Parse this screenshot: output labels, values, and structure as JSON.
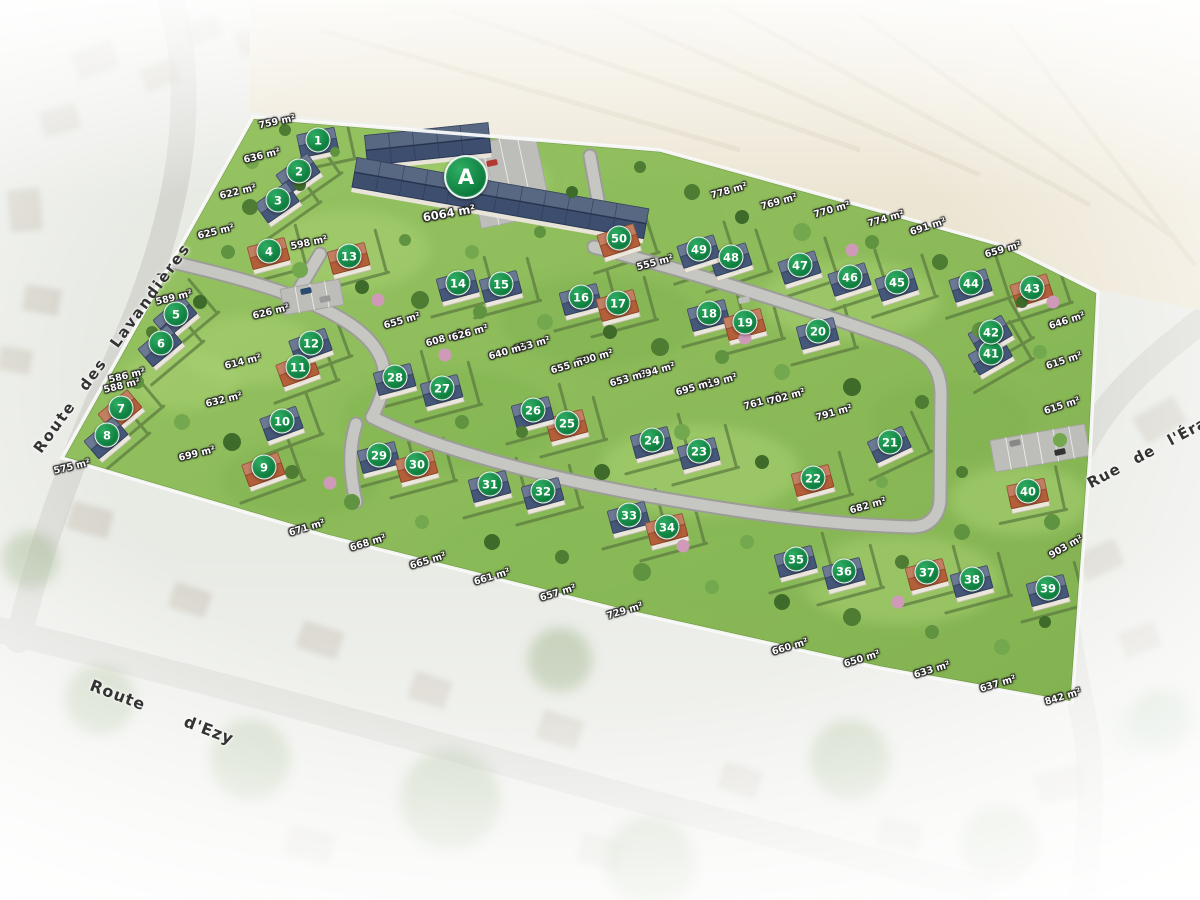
{
  "plan": {
    "type": "residential-subdivision-aerial-plan",
    "marker_color": "#0b7a3c",
    "roof_slate_color": "#46587a",
    "roof_tile_color": "#b35f3a",
    "lawn_color": "#8fbe5c",
    "road_color": "#c6c6c2",
    "field_color": "#ece5d3"
  },
  "streets": [
    {
      "name": "Route des Lavandières",
      "x": 112,
      "y": 348,
      "rot": -54
    },
    {
      "name": "Route d'Ezy",
      "x": 162,
      "y": 712,
      "rot": 21
    },
    {
      "name": "Rue de l'Érable",
      "x": 1160,
      "y": 446,
      "rot": -28
    }
  ],
  "special_lot": {
    "label": "A",
    "x": 466,
    "y": 177,
    "area": "6064 m²",
    "area_x": 449,
    "area_y": 213,
    "area_rot": -10
  },
  "lots": [
    {
      "n": 1,
      "x": 318,
      "y": 140,
      "roof": "slate",
      "rot": -12
    },
    {
      "n": 2,
      "x": 299,
      "y": 171,
      "roof": "slate",
      "rot": -35
    },
    {
      "n": 3,
      "x": 278,
      "y": 200,
      "roof": "slate",
      "rot": -35
    },
    {
      "n": 4,
      "x": 269,
      "y": 251,
      "roof": "tile",
      "rot": -15
    },
    {
      "n": 5,
      "x": 176,
      "y": 314,
      "roof": "slate",
      "rot": -40
    },
    {
      "n": 6,
      "x": 161,
      "y": 343,
      "roof": "slate",
      "rot": -40
    },
    {
      "n": 7,
      "x": 121,
      "y": 408,
      "roof": "tile",
      "rot": -40
    },
    {
      "n": 8,
      "x": 107,
      "y": 435,
      "roof": "slate",
      "rot": -40
    },
    {
      "n": 9,
      "x": 264,
      "y": 467,
      "roof": "tile",
      "rot": -20
    },
    {
      "n": 10,
      "x": 282,
      "y": 421,
      "roof": "slate",
      "rot": -20
    },
    {
      "n": 11,
      "x": 298,
      "y": 367,
      "roof": "tile",
      "rot": -20
    },
    {
      "n": 12,
      "x": 311,
      "y": 343,
      "roof": "slate",
      "rot": -20
    },
    {
      "n": 13,
      "x": 349,
      "y": 256,
      "roof": "tile",
      "rot": -15
    },
    {
      "n": 14,
      "x": 458,
      "y": 283,
      "roof": "slate",
      "rot": -15
    },
    {
      "n": 15,
      "x": 501,
      "y": 284,
      "roof": "slate",
      "rot": -15
    },
    {
      "n": 16,
      "x": 581,
      "y": 297,
      "roof": "slate",
      "rot": -15
    },
    {
      "n": 17,
      "x": 618,
      "y": 303,
      "roof": "tile",
      "rot": -15
    },
    {
      "n": 18,
      "x": 709,
      "y": 313,
      "roof": "slate",
      "rot": -15
    },
    {
      "n": 19,
      "x": 745,
      "y": 322,
      "roof": "tile",
      "rot": -15
    },
    {
      "n": 20,
      "x": 818,
      "y": 331,
      "roof": "slate",
      "rot": -15
    },
    {
      "n": 21,
      "x": 890,
      "y": 442,
      "roof": "slate",
      "rot": -25
    },
    {
      "n": 22,
      "x": 813,
      "y": 478,
      "roof": "tile",
      "rot": -15
    },
    {
      "n": 23,
      "x": 699,
      "y": 451,
      "roof": "slate",
      "rot": -15
    },
    {
      "n": 24,
      "x": 652,
      "y": 440,
      "roof": "slate",
      "rot": -15
    },
    {
      "n": 25,
      "x": 567,
      "y": 423,
      "roof": "tile",
      "rot": -15
    },
    {
      "n": 26,
      "x": 533,
      "y": 410,
      "roof": "slate",
      "rot": -15
    },
    {
      "n": 27,
      "x": 442,
      "y": 388,
      "roof": "slate",
      "rot": -15
    },
    {
      "n": 28,
      "x": 395,
      "y": 377,
      "roof": "slate",
      "rot": -15
    },
    {
      "n": 29,
      "x": 379,
      "y": 455,
      "roof": "slate",
      "rot": -15
    },
    {
      "n": 30,
      "x": 417,
      "y": 464,
      "roof": "tile",
      "rot": -15
    },
    {
      "n": 31,
      "x": 490,
      "y": 484,
      "roof": "slate",
      "rot": -15
    },
    {
      "n": 32,
      "x": 543,
      "y": 491,
      "roof": "slate",
      "rot": -15
    },
    {
      "n": 33,
      "x": 629,
      "y": 515,
      "roof": "slate",
      "rot": -15
    },
    {
      "n": 34,
      "x": 667,
      "y": 527,
      "roof": "tile",
      "rot": -15
    },
    {
      "n": 35,
      "x": 796,
      "y": 559,
      "roof": "slate",
      "rot": -15
    },
    {
      "n": 36,
      "x": 844,
      "y": 571,
      "roof": "slate",
      "rot": -15
    },
    {
      "n": 37,
      "x": 927,
      "y": 572,
      "roof": "tile",
      "rot": -15
    },
    {
      "n": 38,
      "x": 972,
      "y": 579,
      "roof": "slate",
      "rot": -15
    },
    {
      "n": 39,
      "x": 1048,
      "y": 588,
      "roof": "slate",
      "rot": -15
    },
    {
      "n": 40,
      "x": 1028,
      "y": 491,
      "roof": "tile",
      "rot": -12
    },
    {
      "n": 41,
      "x": 991,
      "y": 353,
      "roof": "slate",
      "rot": -30
    },
    {
      "n": 42,
      "x": 991,
      "y": 332,
      "roof": "slate",
      "rot": -30
    },
    {
      "n": 43,
      "x": 1032,
      "y": 288,
      "roof": "tile",
      "rot": -18
    },
    {
      "n": 44,
      "x": 971,
      "y": 283,
      "roof": "slate",
      "rot": -18
    },
    {
      "n": 45,
      "x": 897,
      "y": 282,
      "roof": "slate",
      "rot": -18
    },
    {
      "n": 46,
      "x": 850,
      "y": 277,
      "roof": "slate",
      "rot": -18
    },
    {
      "n": 47,
      "x": 800,
      "y": 265,
      "roof": "slate",
      "rot": -18
    },
    {
      "n": 48,
      "x": 731,
      "y": 257,
      "roof": "slate",
      "rot": -18
    },
    {
      "n": 49,
      "x": 699,
      "y": 249,
      "roof": "slate",
      "rot": -18
    },
    {
      "n": 50,
      "x": 619,
      "y": 238,
      "roof": "tile",
      "rot": -18
    }
  ],
  "areas": [
    {
      "text": "759 m²",
      "x": 277,
      "y": 122,
      "rot": -12
    },
    {
      "text": "636 m²",
      "x": 262,
      "y": 156,
      "rot": -14
    },
    {
      "text": "622 m²",
      "x": 238,
      "y": 192,
      "rot": -14
    },
    {
      "text": "625 m²",
      "x": 216,
      "y": 232,
      "rot": -14
    },
    {
      "text": "598 m²",
      "x": 309,
      "y": 243,
      "rot": -12
    },
    {
      "text": "555 m²",
      "x": 655,
      "y": 263,
      "rot": -15
    },
    {
      "text": "778 m²",
      "x": 729,
      "y": 191,
      "rot": -16
    },
    {
      "text": "769 m²",
      "x": 779,
      "y": 202,
      "rot": -16
    },
    {
      "text": "770 m²",
      "x": 832,
      "y": 210,
      "rot": -16
    },
    {
      "text": "774 m²",
      "x": 886,
      "y": 219,
      "rot": -16
    },
    {
      "text": "691 m²",
      "x": 928,
      "y": 227,
      "rot": -18
    },
    {
      "text": "659 m²",
      "x": 1003,
      "y": 250,
      "rot": -16
    },
    {
      "text": "646 m²",
      "x": 1067,
      "y": 321,
      "rot": -18
    },
    {
      "text": "615 m²",
      "x": 1064,
      "y": 361,
      "rot": -18
    },
    {
      "text": "615 m²",
      "x": 1062,
      "y": 406,
      "rot": -18
    },
    {
      "text": "589 m²",
      "x": 174,
      "y": 298,
      "rot": -14
    },
    {
      "text": "626 m²",
      "x": 271,
      "y": 312,
      "rot": -14
    },
    {
      "text": "586 m²",
      "x": 127,
      "y": 376,
      "rot": -14
    },
    {
      "text": "588 m²",
      "x": 122,
      "y": 386,
      "rot": -14
    },
    {
      "text": "614 m²",
      "x": 243,
      "y": 362,
      "rot": -14
    },
    {
      "text": "632 m²",
      "x": 224,
      "y": 400,
      "rot": -14
    },
    {
      "text": "575 m²",
      "x": 72,
      "y": 467,
      "rot": -14
    },
    {
      "text": "699 m²",
      "x": 197,
      "y": 454,
      "rot": -14
    },
    {
      "text": "655 m²",
      "x": 402,
      "y": 321,
      "rot": -16
    },
    {
      "text": "608 m²",
      "x": 444,
      "y": 339,
      "rot": -16
    },
    {
      "text": "626 m²",
      "x": 470,
      "y": 333,
      "rot": -16
    },
    {
      "text": "653 m²",
      "x": 532,
      "y": 345,
      "rot": -16
    },
    {
      "text": "640 m²",
      "x": 507,
      "y": 352,
      "rot": -16
    },
    {
      "text": "700 m²",
      "x": 595,
      "y": 358,
      "rot": -16
    },
    {
      "text": "655 m²",
      "x": 569,
      "y": 366,
      "rot": -16
    },
    {
      "text": "694 m²",
      "x": 657,
      "y": 371,
      "rot": -16
    },
    {
      "text": "653 m²",
      "x": 628,
      "y": 379,
      "rot": -16
    },
    {
      "text": "719 m²",
      "x": 719,
      "y": 382,
      "rot": -16
    },
    {
      "text": "695 m²",
      "x": 694,
      "y": 388,
      "rot": -16
    },
    {
      "text": "761 m²",
      "x": 762,
      "y": 402,
      "rot": -16
    },
    {
      "text": "702 m²",
      "x": 787,
      "y": 397,
      "rot": -16
    },
    {
      "text": "791 m²",
      "x": 834,
      "y": 413,
      "rot": -16
    },
    {
      "text": "671 m²",
      "x": 307,
      "y": 528,
      "rot": -17
    },
    {
      "text": "668 m²",
      "x": 368,
      "y": 543,
      "rot": -17
    },
    {
      "text": "665 m²",
      "x": 428,
      "y": 561,
      "rot": -17
    },
    {
      "text": "661 m²",
      "x": 492,
      "y": 577,
      "rot": -17
    },
    {
      "text": "657 m²",
      "x": 558,
      "y": 593,
      "rot": -17
    },
    {
      "text": "729 m²",
      "x": 625,
      "y": 611,
      "rot": -17
    },
    {
      "text": "660 m²",
      "x": 790,
      "y": 647,
      "rot": -17
    },
    {
      "text": "650 m²",
      "x": 862,
      "y": 659,
      "rot": -17
    },
    {
      "text": "633 m²",
      "x": 932,
      "y": 670,
      "rot": -17
    },
    {
      "text": "637 m²",
      "x": 998,
      "y": 684,
      "rot": -17
    },
    {
      "text": "842 m²",
      "x": 1063,
      "y": 697,
      "rot": -17
    },
    {
      "text": "682 m²",
      "x": 868,
      "y": 506,
      "rot": -16
    },
    {
      "text": "903 m²",
      "x": 1066,
      "y": 547,
      "rot": -30
    }
  ]
}
